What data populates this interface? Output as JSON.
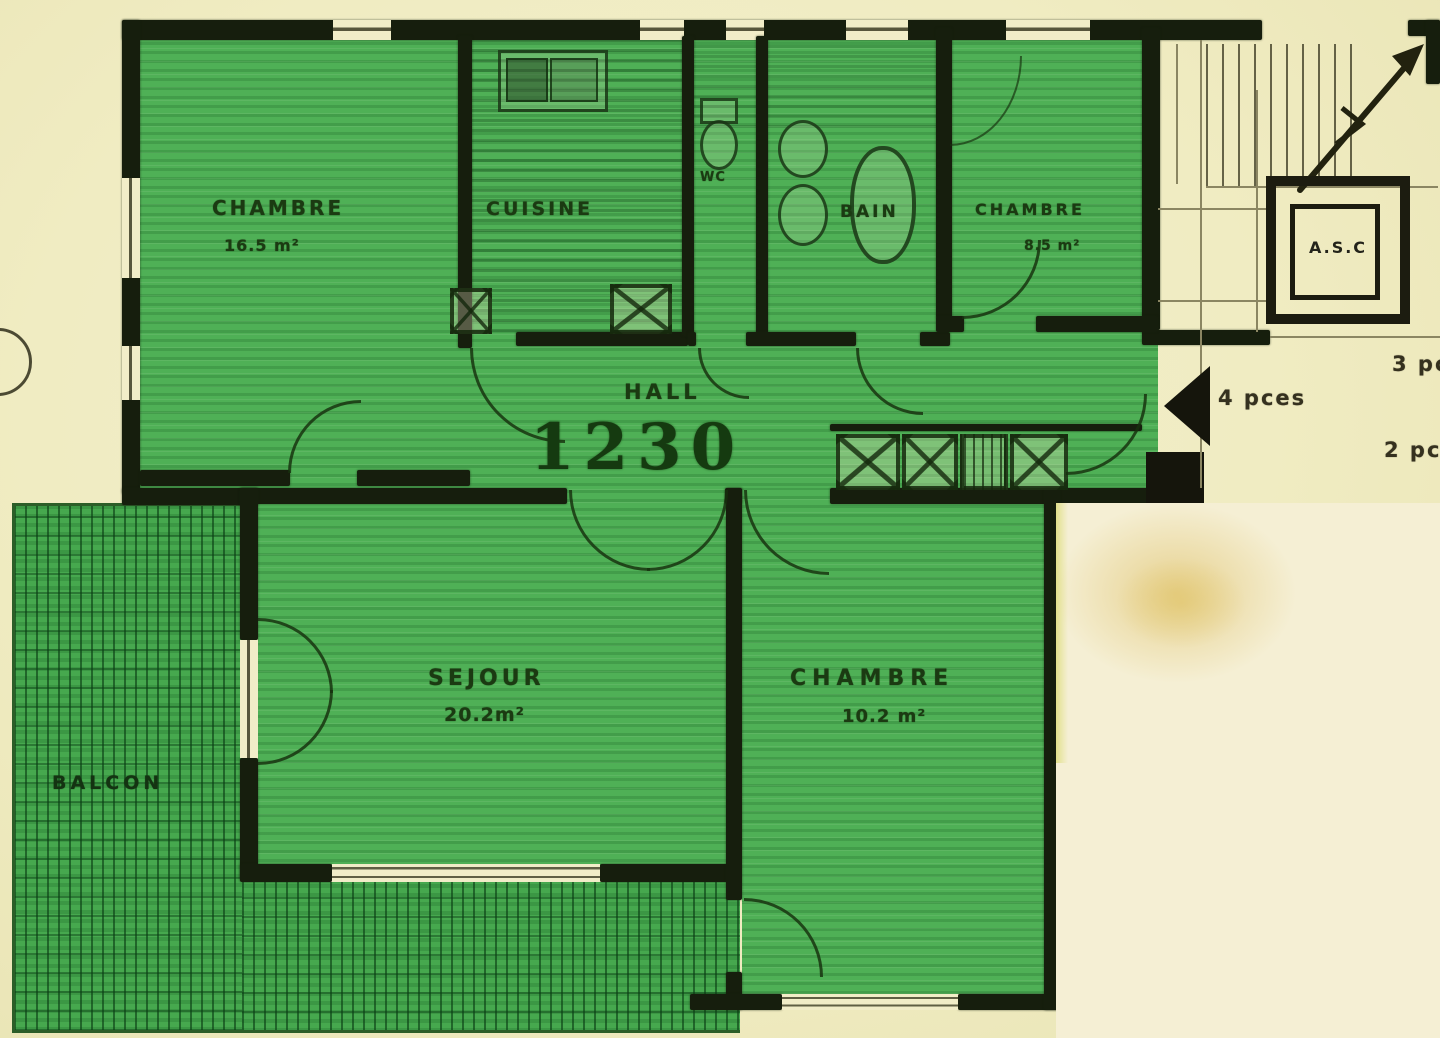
{
  "title": "Apartment floor plan (scanned drawing)",
  "palette": {
    "paper": "#f0ecc2",
    "paper_patch": "#f5efd4",
    "apartment_green": "#4fb056",
    "balcony_green": "#46a84e",
    "wall_ink": "#161e0d",
    "label_ink": "#1b3a12",
    "annotation_ink": "#35311f"
  },
  "rooms": {
    "chambre_tl": {
      "name": "CHAMBRE",
      "area": "16.5 m²"
    },
    "cuisine": {
      "name": "CUISINE"
    },
    "wc": {
      "name": "WC"
    },
    "bain": {
      "name": "BAIN"
    },
    "chambre_tr": {
      "name": "CHAMBRE",
      "area": "8.5 m²"
    },
    "hall": {
      "name": "HALL",
      "dimension": "1230"
    },
    "sejour": {
      "name": "SEJOUR",
      "area": "20.2m²"
    },
    "chambre_b": {
      "name": "CHAMBRE",
      "area": "10.2 m²"
    },
    "balcon": {
      "name": "BALCON"
    }
  },
  "elevator": {
    "label": "A.S.C"
  },
  "annotations": {
    "four_rooms": "4 pces",
    "three_rooms": "3 pces",
    "two_rooms": "2 pces"
  }
}
